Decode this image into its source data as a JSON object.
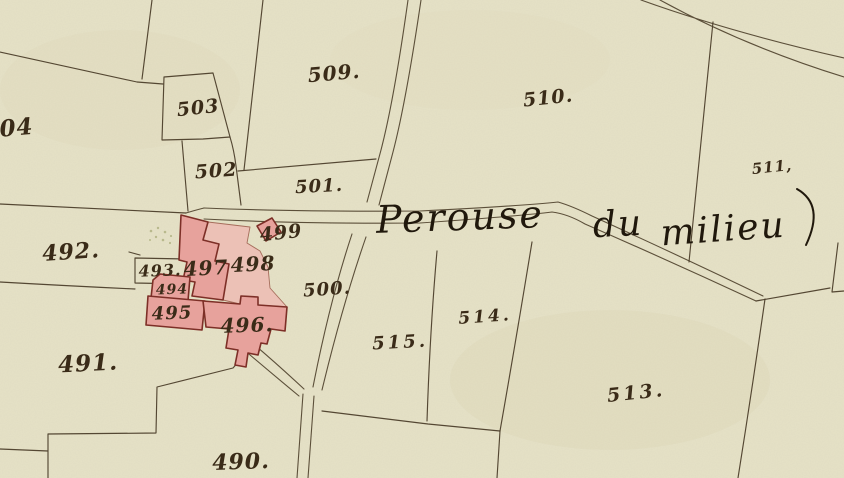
{
  "map": {
    "kind": "historical cadastral map",
    "place_name": "Perouse du milieu",
    "title_words": [
      {
        "text": "Perouse"
      },
      {
        "text": "du"
      },
      {
        "text": "milieu"
      }
    ],
    "labels": [
      {
        "parcel": "490",
        "text": "490."
      },
      {
        "parcel": "491",
        "text": "491."
      },
      {
        "parcel": "492",
        "text": "492."
      },
      {
        "parcel": "493",
        "text": "493."
      },
      {
        "parcel": "494",
        "text": "494"
      },
      {
        "parcel": "495",
        "text": "495"
      },
      {
        "parcel": "496",
        "text": "496."
      },
      {
        "parcel": "497",
        "text": "497"
      },
      {
        "parcel": "498",
        "text": "498"
      },
      {
        "parcel": "499",
        "text": "499"
      },
      {
        "parcel": "500",
        "text": "500."
      },
      {
        "parcel": "501",
        "text": "501."
      },
      {
        "parcel": "502",
        "text": "502"
      },
      {
        "parcel": "503",
        "text": "503"
      },
      {
        "parcel": "504",
        "text": "504"
      },
      {
        "parcel": "509",
        "text": "509."
      },
      {
        "parcel": "510",
        "text": "510."
      },
      {
        "parcel": "511",
        "text": "511,"
      },
      {
        "parcel": "513",
        "text": "513."
      },
      {
        "parcel": "514",
        "text": "514."
      },
      {
        "parcel": "515",
        "text": "515."
      }
    ],
    "colors": {
      "paper": "#e6e2c7",
      "ink_lines": "#483a26",
      "ink_numbers": "#3a2b18",
      "ink_script": "#20180c",
      "building_fill": "#e7a29c",
      "building_wash": "#eebcb4",
      "building_outline": "#7d2f27",
      "highlight_number": "#b06c1e"
    }
  }
}
